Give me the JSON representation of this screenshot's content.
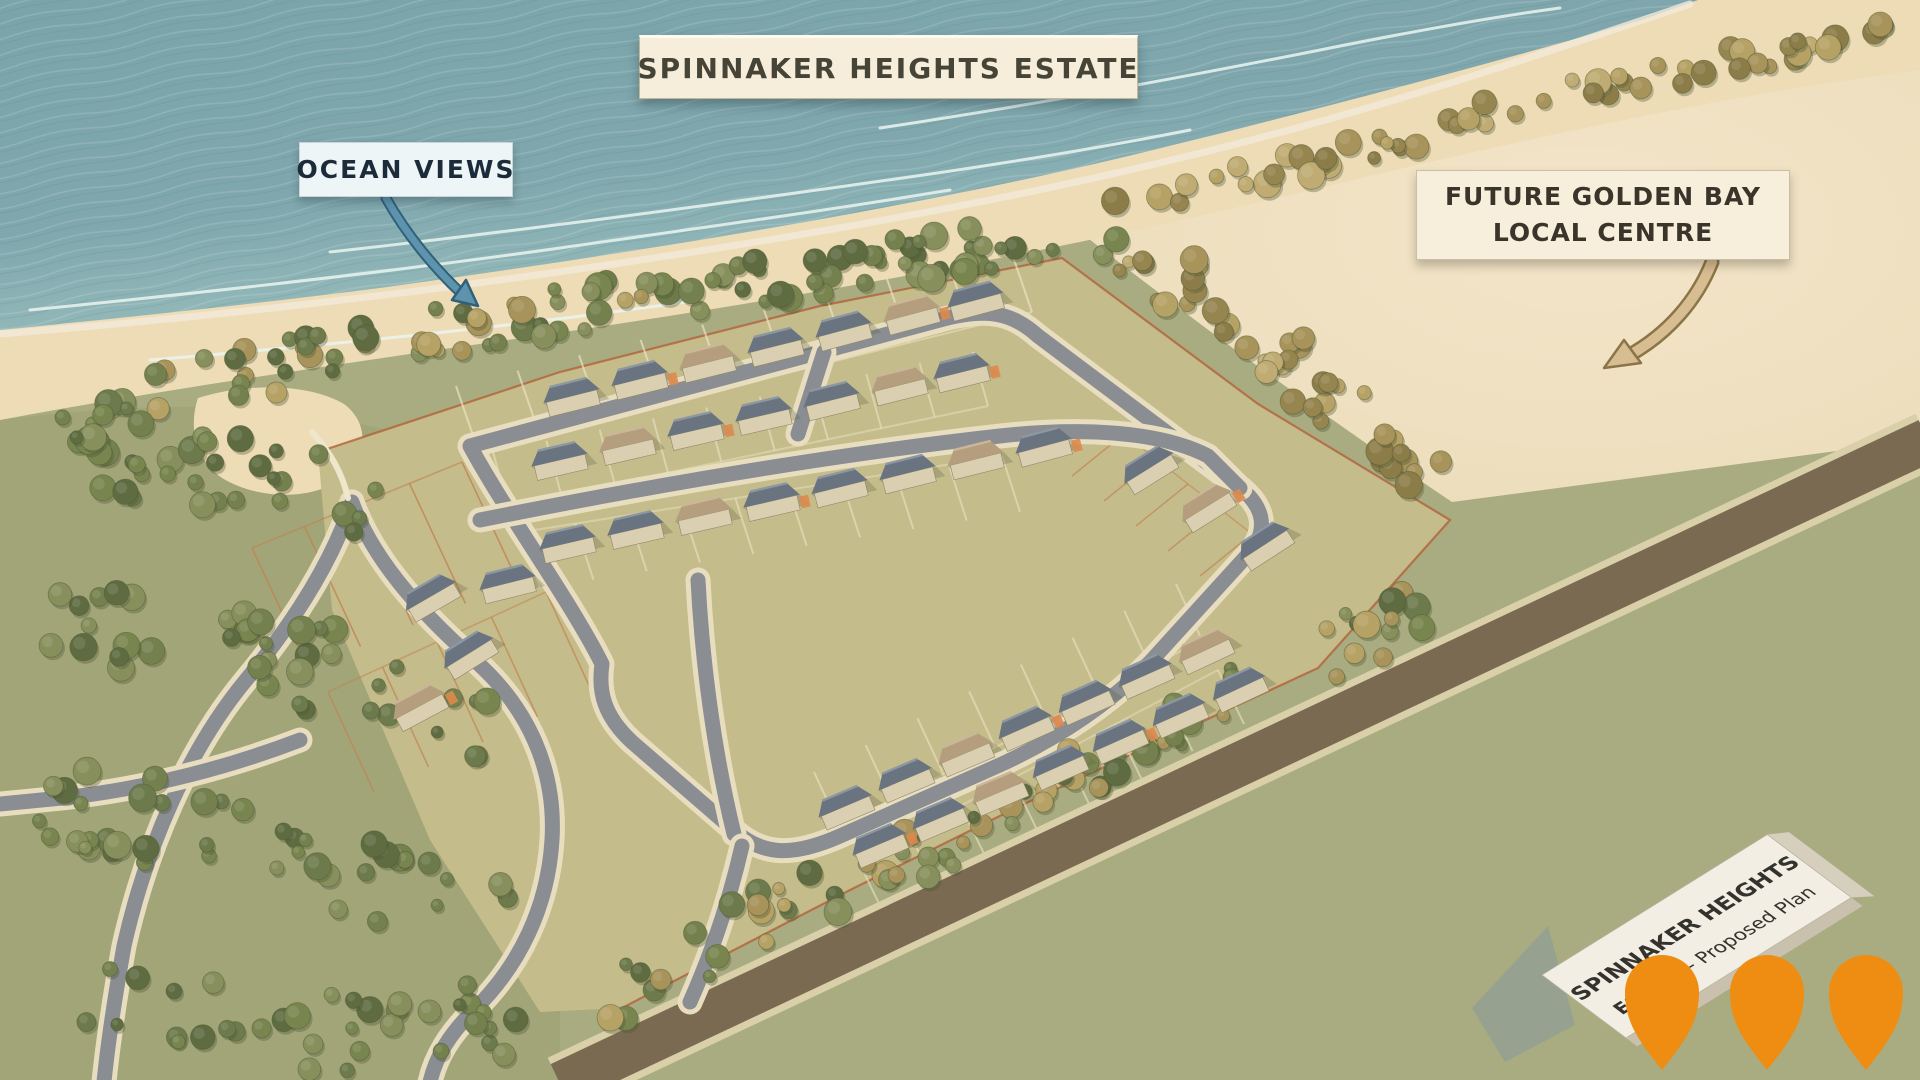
{
  "title_banner": {
    "label": "SPINNAKER HEIGHTS ESTATE"
  },
  "annotations": {
    "ocean_views": {
      "label": "OCEAN VIEWS",
      "arrow_color": "#5e93ad"
    },
    "future_centre": {
      "line1": "FUTURE GOLDEN BAY",
      "line2": "LOCAL CENTRE",
      "arrow_color": "#d9bd92"
    }
  },
  "sign": {
    "line1": "SPINNAKER HEIGHTS",
    "line2_bold": "ESTATE",
    "line2_rest": " - Proposed Plan"
  },
  "map": {
    "colors": {
      "ocean_deep": "#6e98a1",
      "ocean": "#7fa7ad",
      "ocean_shallow": "#a3c4c3",
      "beach": "#eedcb7",
      "field": "#a9ac80",
      "estate_ground": "#c5bc8c",
      "open_area": "#ecdfc2",
      "road": "#8a8e92",
      "road_casing": "#e8debf",
      "rural_road": "#7b6a52",
      "boundary_line": "#b2613a",
      "roof_slate": "#6a7480",
      "roof_tan": "#b49e7e",
      "walls": "#dbcfb2",
      "tree_olive": "#6d7a4b",
      "tree_gold": "#a8935a",
      "pin": "#ef8d13"
    },
    "geometry": [
      {
        "name": "field-backdrop",
        "cls": "none",
        "d": ""
      },
      {
        "name": "open-area",
        "cls": "cream",
        "d": "M1080,232 C1180,206 1330,168 1470,128 C1630,84 1780,62 1920,48 L1920,440 L1452,502 C1330,420 1205,330 1080,232 Z"
      },
      {
        "name": "woodland-tint",
        "cls": "woods",
        "d": "M0,420 C150,400 300,400 420,440 L560,640 L560,1080 L0,1080 Z"
      },
      {
        "name": "beach",
        "cls": "beachfill",
        "d": "M0,0 L1920,0 L1920,70 C1690,100 1470,152 1260,202 C1050,252 810,296 550,334 C350,362 150,392 0,420 Z"
      },
      {
        "name": "sand-cove",
        "cls": "beachfill",
        "d": "M198,398 C250,382 310,384 344,404 C368,422 368,452 348,474 C316,502 258,500 222,478 C196,460 188,428 198,398 Z"
      },
      {
        "name": "ocean",
        "cls": "ocean",
        "d": "M0,0 L1698,0 L1642,20 C1460,72 1278,120 1120,158 C900,210 640,252 380,288 C240,306 100,320 0,330 Z"
      },
      {
        "name": "ocean-texture",
        "cls": "oceanTex",
        "d": "M0,0 L1698,0 L1642,20 C1460,72 1278,120 1120,158 C900,210 640,252 380,288 C240,306 100,320 0,330 Z"
      },
      {
        "name": "wet-sand-line",
        "cls": "wet",
        "d": "M0,334 C150,322 300,306 440,288 C700,254 960,212 1180,158 C1380,110 1560,48 1690,4"
      },
      {
        "name": "foam-1",
        "cls": "foam",
        "d": "M30,310 C210,292 390,272 560,248 C700,228 830,210 950,190"
      },
      {
        "name": "foam-2",
        "cls": "foam",
        "d": "M330,252 C510,232 690,208 860,184 C990,166 1100,148 1190,130"
      },
      {
        "name": "foam-3",
        "cls": "foam",
        "d": "M880,128 C1040,104 1190,76 1330,48 C1420,30 1500,16 1560,8"
      },
      {
        "name": "foam-4",
        "cls": "foam",
        "d": "M150,360 C340,344 520,326 700,300"
      },
      {
        "name": "estate-ground",
        "cls": "estate",
        "d": "M318,452 L560,372 L820,306 L1062,258 L1258,404 L1450,520 L1318,668 L1020,806 L850,890 L622,1008 L540,1012 L430,840 L332,610 Z"
      },
      {
        "name": "estate-boundary",
        "cls": "boundary",
        "d": "M318,452 L560,372 L820,306 L1062,258 L1258,404 L1450,520 L1318,668 L1020,806 L850,890 L622,1008"
      }
    ],
    "roads": [
      {
        "kind": "brown",
        "name": "rural-road",
        "d": "M560,1084 L1928,440"
      },
      {
        "kind": "gray",
        "name": "loop-road",
        "d": "M470,446 L940,320 C988,307 1012,313 1038,336 L1238,486 C1264,506 1268,528 1252,550 L1152,660 C1112,702 1062,736 1002,764 L840,836 C790,858 762,854 736,832 L632,742 C604,716 598,692 602,664 C570,600 508,516 470,446 Z"
      },
      {
        "kind": "gray",
        "name": "spine-road",
        "d": "M480,520 C640,488 820,456 1000,436 C1080,427 1160,431 1208,456 L1240,488"
      },
      {
        "kind": "gray",
        "name": "connector-north",
        "d": "M824,352 L798,434"
      },
      {
        "kind": "gray",
        "name": "connector-south",
        "d": "M698,580 C702,660 714,752 734,834"
      },
      {
        "kind": "gray",
        "name": "south-entrance",
        "d": "M742,846 C730,898 714,948 690,1002"
      },
      {
        "kind": "gray",
        "name": "park-road",
        "d": "M352,502 C332,562 294,622 246,680 C188,750 146,848 124,946 C114,1002 108,1042 104,1082"
      },
      {
        "kind": "gray",
        "name": "park-branch",
        "d": "M300,740 C232,766 152,788 62,798 L0,804"
      },
      {
        "kind": "gray",
        "name": "park-spur",
        "d": "M352,502 C372,558 420,612 472,658 C530,708 556,772 552,840 C548,906 520,966 472,1012 C450,1034 436,1056 430,1082"
      },
      {
        "kind": "white",
        "name": "beach-path",
        "d": "M312,432 C330,452 342,472 348,498"
      }
    ],
    "lot_rows": [
      {
        "a": [
          478,
          450
        ],
        "b": [
          1032,
          312
        ],
        "n": 9,
        "dir": [
          -22,
          -64
        ],
        "stroke": "#ece2c2",
        "w": 2,
        "op": 0.7
      },
      {
        "a": [
          508,
          506
        ],
        "b": [
          988,
          406
        ],
        "n": 9,
        "dir": [
          -15,
          -54
        ],
        "stroke": "#ece2c2",
        "w": 2,
        "op": 0.6
      },
      {
        "a": [
          522,
          532
        ],
        "b": [
          1002,
          456
        ],
        "n": 9,
        "dir": [
          18,
          56
        ],
        "stroke": "#ece2c2",
        "w": 2,
        "op": 0.6
      },
      {
        "a": [
          840,
          828
        ],
        "b": [
          1202,
          640
        ],
        "n": 7,
        "dir": [
          -26,
          -56
        ],
        "stroke": "#ece2c2",
        "w": 2,
        "op": 0.6
      },
      {
        "a": [
          858,
          860
        ],
        "b": [
          1218,
          670
        ],
        "n": 7,
        "dir": [
          26,
          54
        ],
        "stroke": "#ece2c2",
        "w": 2,
        "op": 0.6
      },
      {
        "a": [
          252,
          548
        ],
        "b": [
          462,
          462
        ],
        "n": 4,
        "dir": [
          56,
          120
        ],
        "stroke": "#c08552",
        "w": 1.6,
        "op": 0.8
      },
      {
        "a": [
          328,
          692
        ],
        "b": [
          546,
          592
        ],
        "n": 4,
        "dir": [
          46,
          100
        ],
        "stroke": "#c08552",
        "w": 1.6,
        "op": 0.7
      },
      {
        "a": [
          1124,
          434
        ],
        "b": [
          1252,
          534
        ],
        "n": 4,
        "dir": [
          -52,
          42
        ],
        "stroke": "#c08552",
        "w": 1.5,
        "op": 0.7
      }
    ],
    "houses": [
      [
        572,
        398,
        -14,
        "s"
      ],
      [
        640,
        381,
        -14,
        "s"
      ],
      [
        708,
        364,
        -14,
        "t"
      ],
      [
        776,
        348,
        -14,
        "s"
      ],
      [
        844,
        332,
        -15,
        "s"
      ],
      [
        912,
        316,
        -15,
        "t"
      ],
      [
        976,
        302,
        -15,
        "s"
      ],
      [
        560,
        462,
        -13,
        "s"
      ],
      [
        628,
        447,
        -13,
        "t"
      ],
      [
        696,
        432,
        -13,
        "s"
      ],
      [
        764,
        417,
        -13,
        "s"
      ],
      [
        832,
        402,
        -14,
        "s"
      ],
      [
        900,
        387,
        -14,
        "t"
      ],
      [
        962,
        374,
        -14,
        "s"
      ],
      [
        568,
        545,
        -13,
        "s"
      ],
      [
        636,
        531,
        -13,
        "s"
      ],
      [
        704,
        517,
        -13,
        "t"
      ],
      [
        772,
        503,
        -13,
        "s"
      ],
      [
        840,
        489,
        -14,
        "s"
      ],
      [
        908,
        475,
        -14,
        "s"
      ],
      [
        976,
        461,
        -14,
        "t"
      ],
      [
        1044,
        448,
        -15,
        "s"
      ],
      [
        846,
        808,
        -23,
        "s"
      ],
      [
        906,
        781,
        -23,
        "s"
      ],
      [
        966,
        755,
        -23,
        "t"
      ],
      [
        1026,
        729,
        -24,
        "s"
      ],
      [
        1086,
        703,
        -24,
        "s"
      ],
      [
        1146,
        677,
        -24,
        "s"
      ],
      [
        1206,
        652,
        -25,
        "t"
      ],
      [
        880,
        846,
        -23,
        "s"
      ],
      [
        940,
        820,
        -23,
        "s"
      ],
      [
        1000,
        794,
        -23,
        "t"
      ],
      [
        1060,
        768,
        -24,
        "s"
      ],
      [
        1120,
        742,
        -24,
        "s"
      ],
      [
        1180,
        716,
        -24,
        "s"
      ],
      [
        1240,
        690,
        -25,
        "s"
      ],
      [
        1150,
        470,
        -32,
        "s"
      ],
      [
        1208,
        508,
        -32,
        "t"
      ],
      [
        1266,
        546,
        -33,
        "s"
      ],
      [
        432,
        598,
        -30,
        "s"
      ],
      [
        470,
        655,
        -32,
        "s"
      ],
      [
        420,
        708,
        -28,
        "t"
      ],
      [
        508,
        585,
        -14,
        "s"
      ]
    ],
    "tree_bands": [
      {
        "pts": [
          [
            150,
            398
          ],
          [
            320,
            355
          ],
          [
            520,
            318
          ],
          [
            700,
            290
          ]
        ],
        "hw": 26,
        "n": 55,
        "pal": "mix"
      },
      {
        "pts": [
          [
            700,
            290
          ],
          [
            880,
            262
          ],
          [
            1060,
            240
          ],
          [
            1120,
            235
          ]
        ],
        "hw": 24,
        "n": 45,
        "pal": "olive"
      },
      {
        "pts": [
          [
            1130,
            248
          ],
          [
            1240,
            318
          ],
          [
            1340,
            408
          ],
          [
            1430,
            478
          ]
        ],
        "hw": 30,
        "n": 42,
        "pal": "gold"
      },
      {
        "pts": [
          [
            600,
            1000
          ],
          [
            780,
            912
          ],
          [
            980,
            820
          ],
          [
            1180,
            726
          ],
          [
            1360,
            640
          ],
          [
            1430,
            598
          ]
        ],
        "hw": 30,
        "n": 75,
        "pal": "mix"
      },
      {
        "pts": [
          [
            1080,
            215
          ],
          [
            1300,
            165
          ],
          [
            1520,
            105
          ],
          [
            1720,
            62
          ],
          [
            1900,
            28
          ]
        ],
        "hw": 14,
        "n": 55,
        "pal": "gold"
      },
      {
        "pts": [
          [
            60,
            480
          ],
          [
            220,
            470
          ],
          [
            380,
            505
          ]
        ],
        "hw": 40,
        "n": 32,
        "pal": "olive"
      },
      {
        "pts": [
          [
            40,
            620
          ],
          [
            200,
            640
          ],
          [
            380,
            680
          ],
          [
            500,
            740
          ]
        ],
        "hw": 45,
        "n": 42,
        "pal": "olive"
      },
      {
        "pts": [
          [
            40,
            800
          ],
          [
            200,
            830
          ],
          [
            380,
            880
          ],
          [
            500,
            930
          ]
        ],
        "hw": 45,
        "n": 42,
        "pal": "olive"
      },
      {
        "pts": [
          [
            60,
            990
          ],
          [
            220,
            1020
          ],
          [
            400,
            1040
          ],
          [
            520,
            1010
          ]
        ],
        "hw": 40,
        "n": 36,
        "pal": "olive"
      },
      {
        "pts": [
          [
            60,
            430
          ],
          [
            140,
            415
          ]
        ],
        "hw": 18,
        "n": 10,
        "pal": "olive"
      }
    ],
    "arrows": {
      "ocean": {
        "d": "M386,198 C405,232 432,266 462,294",
        "head": "478,306 452,300 466,280",
        "fill": "#5e93ad",
        "outline": "#30607a",
        "w": 7,
        "cw": 11
      },
      "future": {
        "d": "M1712,262 C1697,300 1668,334 1628,356",
        "head": "1604,368 1624,340 1641,363",
        "fill": "#d9bd92",
        "outline": "#8a7547",
        "w": 10,
        "cw": 15
      }
    },
    "pins": {
      "count": 3,
      "color": "#ef8d13",
      "positions_x": [
        1662,
        1767,
        1866
      ],
      "head_y": 992,
      "radius": 37,
      "tip_y": 1070
    }
  }
}
